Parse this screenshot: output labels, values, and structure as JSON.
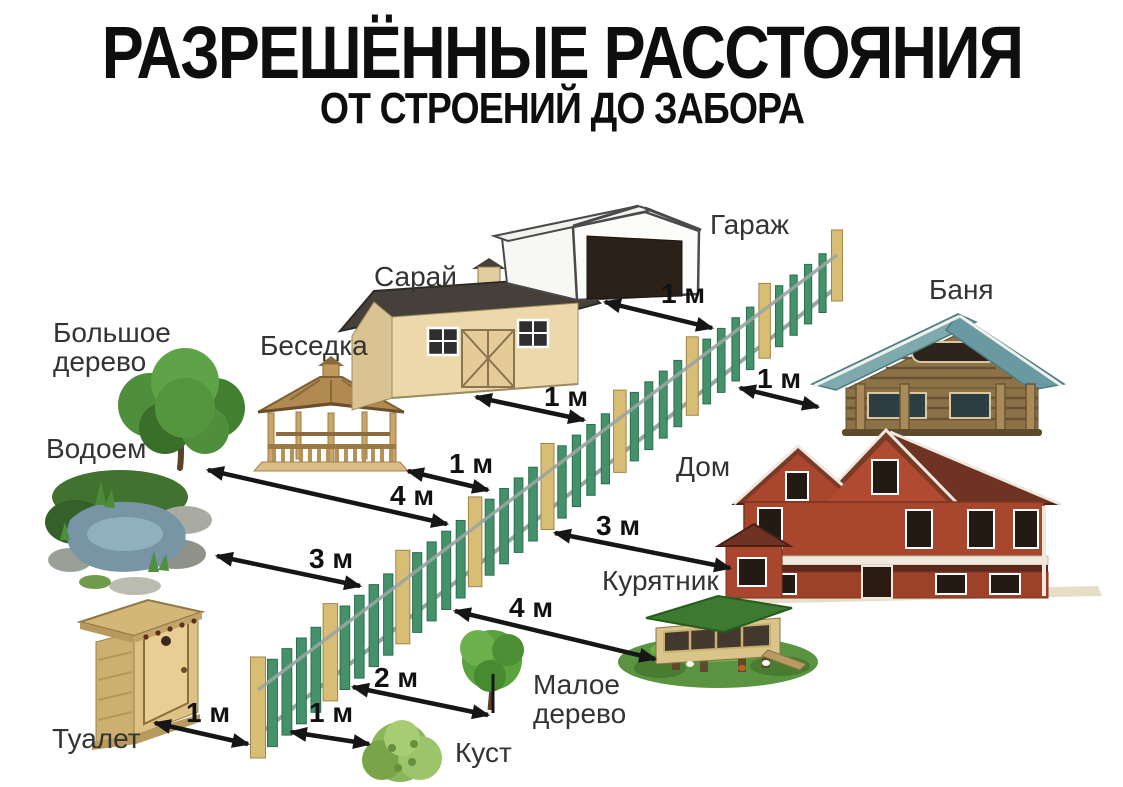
{
  "title": {
    "main": "РАЗРЕШЁННЫЕ РАССТОЯНИЯ",
    "sub": "ОТ СТРОЕНИЙ ДО ЗАБОРА"
  },
  "fence": {
    "name": "забор"
  },
  "colors": {
    "background": "#ffffff",
    "title_text": "#0e0e0e",
    "label_text": "#333333",
    "arrow": "#161616",
    "fence_picket": "#44916a",
    "fence_picket_edge": "#2b6f50",
    "fence_post": "#d8bd75",
    "fence_post_edge": "#a18648",
    "fence_rail": "#9aa5a0"
  },
  "objects": [
    {
      "id": "garage",
      "label": "Гараж",
      "distance": "1 м"
    },
    {
      "id": "shed",
      "label": "Сарай",
      "distance": "1 м"
    },
    {
      "id": "bathhouse",
      "label": "Баня",
      "distance": "1 м"
    },
    {
      "id": "gazebo",
      "label": "Беседка",
      "distance": "1 м"
    },
    {
      "id": "big-tree",
      "label": "Большое дерево",
      "distance": "4 м"
    },
    {
      "id": "house",
      "label": "Дом",
      "distance": "3 м"
    },
    {
      "id": "pond",
      "label": "Водоем",
      "distance": "3 м"
    },
    {
      "id": "chicken-coop",
      "label": "Курятник",
      "distance": "4 м"
    },
    {
      "id": "small-tree",
      "label": "Малое дерево",
      "distance": "2 м"
    },
    {
      "id": "bush",
      "label": "Куст",
      "distance": "1 м"
    },
    {
      "id": "toilet",
      "label": "Туалет",
      "distance": "1 м"
    }
  ]
}
